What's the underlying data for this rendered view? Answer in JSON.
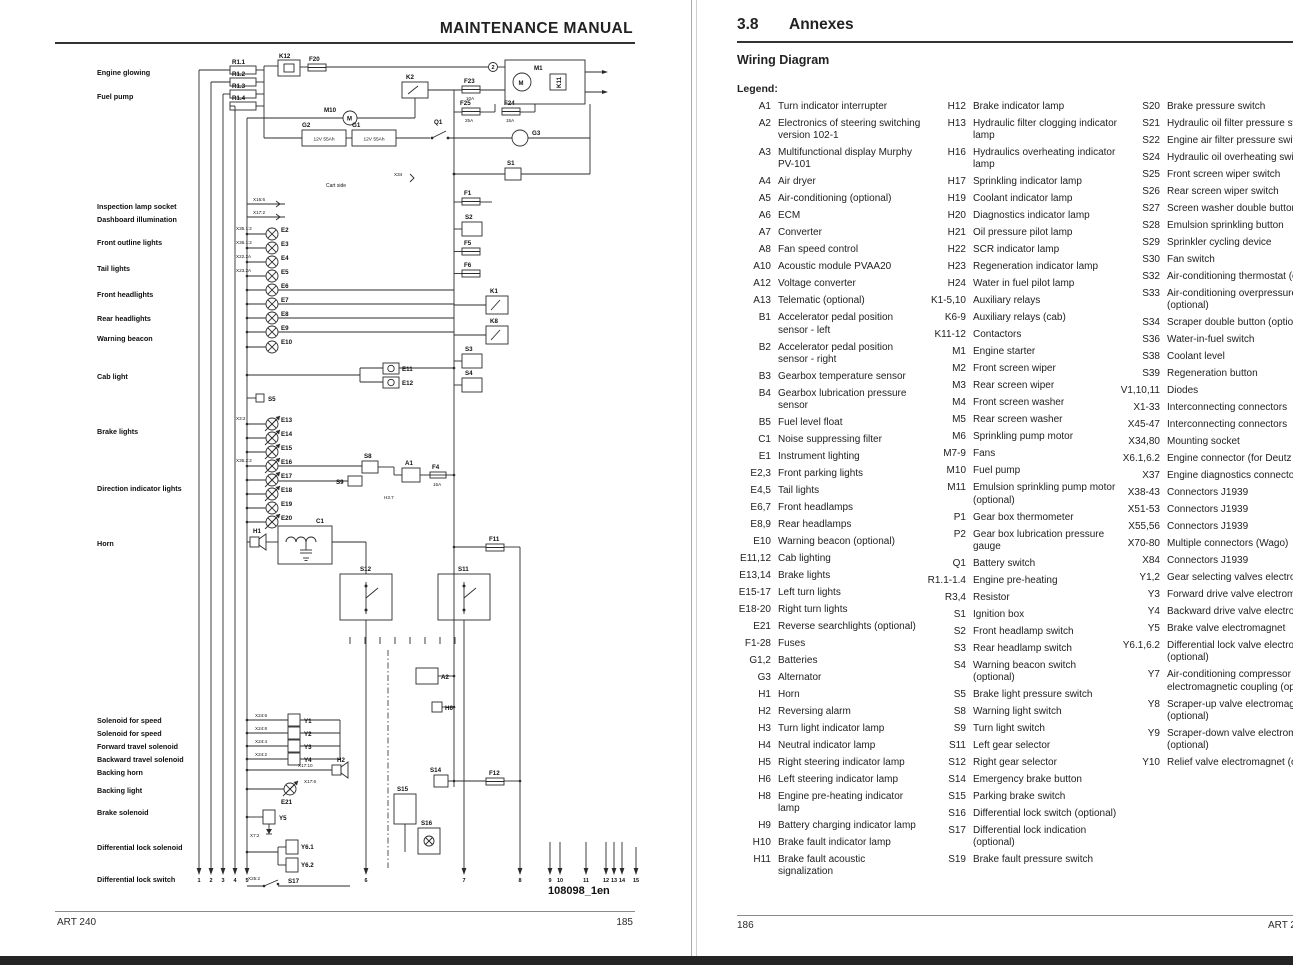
{
  "left_page": {
    "header_title": "MAINTENANCE MANUAL",
    "footer_left": "ART 240",
    "footer_right": "185",
    "diagram": {
      "ref": "108098_1en",
      "side_labels": [
        "Engine glowing",
        "Fuel pump",
        "Inspection lamp socket",
        "Dashboard illumination",
        "Front outline lights",
        "Tail lights",
        "Front headlights",
        "Rear headlights",
        "Warning beacon",
        "Cab light",
        "Brake lights",
        "Direction indicator lights",
        "Horn",
        "Solenoid for speed",
        "Solenoid for speed",
        "Forward travel solenoid",
        "Backward travel solenoid",
        "Backing horn",
        "Backing light",
        "Brake solenoid",
        "Differential lock solenoid",
        "Differential lock switch"
      ],
      "texts": [
        "R1.1",
        "R1.2",
        "R1.3",
        "R1.4",
        "K12",
        "F20",
        "M10",
        "K2",
        "F23",
        "10A",
        "F25",
        "25A",
        "F24",
        "15A",
        "M1",
        "K11",
        "2",
        "G2",
        "12V 55Ah",
        "G1",
        "12V 55Ah",
        "Q1",
        "G3",
        "S1",
        "X34",
        "F1",
        "S2",
        "F5",
        "F6",
        "K1",
        "K8",
        "S3",
        "S4",
        "X16:6",
        "X17:2",
        "E2",
        "E3",
        "E4",
        "E5",
        "E6",
        "E7",
        "E8",
        "E9",
        "E10",
        "X35.1:2",
        "X36.1:2",
        "X22.2A",
        "X23.2A",
        "E11",
        "E12",
        "S5",
        "E13",
        "E14",
        "E15",
        "E16",
        "E17",
        "E18",
        "E19",
        "E20",
        "X3:2",
        "X35.2:2",
        "S8",
        "S9",
        "A1",
        "F4",
        "15A",
        "H3.7",
        "H1",
        "C1",
        "F11",
        "S12",
        "S11",
        "A2",
        "H6",
        "Y1",
        "Y2",
        "Y3",
        "Y4",
        "X24:6",
        "X24:8",
        "X24:4",
        "X24:2",
        "H2",
        "X17:10",
        "E21",
        "X17:6",
        "Y5",
        "Y6.1",
        "Y6.2",
        "S17",
        "X25:2",
        "X7:2",
        "S14",
        "F12",
        "S15",
        "S16",
        "Cart side",
        "M",
        "M"
      ],
      "terminals": [
        "1",
        "2",
        "3",
        "4",
        "5",
        "6",
        "7",
        "8",
        "9",
        "10",
        "11",
        "12",
        "13",
        "14",
        "15"
      ]
    }
  },
  "right_page": {
    "section_number": "3.8",
    "section_title": "Annexes",
    "subtitle": "Wiring Diagram",
    "legend_label": "Legend:",
    "footer_left": "186",
    "footer_right": "ART 240",
    "legend_col1": [
      {
        "k": "A1",
        "d": "Turn indicator interrupter"
      },
      {
        "k": "A2",
        "d": "Electronics of steering switching version 102-1"
      },
      {
        "k": "A3",
        "d": "Multifunctional display Murphy PV-101"
      },
      {
        "k": "A4",
        "d": "Air dryer"
      },
      {
        "k": "A5",
        "d": "Air-conditioning (optional)"
      },
      {
        "k": "A6",
        "d": "ECM"
      },
      {
        "k": "A7",
        "d": "Converter"
      },
      {
        "k": "A8",
        "d": "Fan speed control"
      },
      {
        "k": "A10",
        "d": "Acoustic module PVAA20"
      },
      {
        "k": "A12",
        "d": "Voltage converter"
      },
      {
        "k": "A13",
        "d": "Telematic (optional)"
      },
      {
        "k": "B1",
        "d": "Accelerator pedal position sensor - left"
      },
      {
        "k": "B2",
        "d": "Accelerator pedal position sensor - right"
      },
      {
        "k": "B3",
        "d": "Gearbox temperature sensor"
      },
      {
        "k": "B4",
        "d": "Gearbox lubrication pressure sensor"
      },
      {
        "k": "B5",
        "d": "Fuel level float"
      },
      {
        "k": "C1",
        "d": "Noise suppressing filter"
      },
      {
        "k": "E1",
        "d": "Instrument lighting"
      },
      {
        "k": "E2,3",
        "d": "Front parking lights"
      },
      {
        "k": "E4,5",
        "d": "Tail lights"
      },
      {
        "k": "E6,7",
        "d": "Front headlamps"
      },
      {
        "k": "E8,9",
        "d": "Rear headlamps"
      },
      {
        "k": "E10",
        "d": "Warning beacon (optional)"
      },
      {
        "k": "E11,12",
        "d": "Cab lighting"
      },
      {
        "k": "E13,14",
        "d": "Brake lights"
      },
      {
        "k": "E15-17",
        "d": "Left turn lights"
      },
      {
        "k": "E18-20",
        "d": "Right turn lights"
      },
      {
        "k": "E21",
        "d": "Reverse searchlights (optional)"
      },
      {
        "k": "F1-28",
        "d": "Fuses"
      },
      {
        "k": "G1,2",
        "d": "Batteries"
      },
      {
        "k": "G3",
        "d": "Alternator"
      },
      {
        "k": "H1",
        "d": "Horn"
      },
      {
        "k": "H2",
        "d": "Reversing alarm"
      },
      {
        "k": "H3",
        "d": "Turn light indicator lamp"
      },
      {
        "k": "H4",
        "d": "Neutral indicator lamp"
      },
      {
        "k": "H5",
        "d": "Right steering indicator lamp"
      },
      {
        "k": "H6",
        "d": "Left steering indicator lamp"
      },
      {
        "k": "H8",
        "d": "Engine pre-heating indicator lamp"
      },
      {
        "k": "H9",
        "d": "Battery charging indicator lamp"
      },
      {
        "k": "H10",
        "d": "Brake fault indicator lamp"
      },
      {
        "k": "H11",
        "d": "Brake fault acoustic signalization"
      }
    ],
    "legend_col2": [
      {
        "k": "H12",
        "d": "Brake indicator lamp"
      },
      {
        "k": "H13",
        "d": "Hydraulic filter clogging indicator lamp"
      },
      {
        "k": "H16",
        "d": "Hydraulics overheating indicator lamp"
      },
      {
        "k": "H17",
        "d": "Sprinkling indicator lamp"
      },
      {
        "k": "H19",
        "d": "Coolant indicator lamp"
      },
      {
        "k": "H20",
        "d": "Diagnostics indicator lamp"
      },
      {
        "k": "H21",
        "d": "Oil pressure pilot lamp"
      },
      {
        "k": "H22",
        "d": "SCR indicator lamp"
      },
      {
        "k": "H23",
        "d": "Regeneration indicator lamp"
      },
      {
        "k": "H24",
        "d": "Water in fuel pilot lamp"
      },
      {
        "k": "K1-5,10",
        "d": "Auxiliary relays"
      },
      {
        "k": "K6-9",
        "d": "Auxiliary relays (cab)"
      },
      {
        "k": "K11-12",
        "d": "Contactors"
      },
      {
        "k": "M1",
        "d": "Engine starter"
      },
      {
        "k": "M2",
        "d": "Front screen wiper"
      },
      {
        "k": "M3",
        "d": "Rear screen wiper"
      },
      {
        "k": "M4",
        "d": "Front screen washer"
      },
      {
        "k": "M5",
        "d": "Rear screen washer"
      },
      {
        "k": "M6",
        "d": "Sprinkling pump motor"
      },
      {
        "k": "M7-9",
        "d": "Fans"
      },
      {
        "k": "M10",
        "d": "Fuel pump"
      },
      {
        "k": "M11",
        "d": "Emulsion sprinkling pump motor (optional)"
      },
      {
        "k": "P1",
        "d": "Gear box thermometer"
      },
      {
        "k": "P2",
        "d": "Gear box lubrication pressure gauge"
      },
      {
        "k": "Q1",
        "d": "Battery switch"
      },
      {
        "k": "R1.1-1.4",
        "d": "Engine pre-heating"
      },
      {
        "k": "R3,4",
        "d": "Resistor"
      },
      {
        "k": "S1",
        "d": "Ignition box"
      },
      {
        "k": "S2",
        "d": "Front headlamp switch"
      },
      {
        "k": "S3",
        "d": "Rear headlamp switch"
      },
      {
        "k": "S4",
        "d": "Warning beacon switch (optional)"
      },
      {
        "k": "S5",
        "d": "Brake light pressure switch"
      },
      {
        "k": "S8",
        "d": "Warning light switch"
      },
      {
        "k": "S9",
        "d": "Turn light switch"
      },
      {
        "k": "S11",
        "d": "Left gear selector"
      },
      {
        "k": "S12",
        "d": "Right gear selector"
      },
      {
        "k": "S14",
        "d": "Emergency brake button"
      },
      {
        "k": "S15",
        "d": "Parking brake switch"
      },
      {
        "k": "S16",
        "d": "Differential lock switch (optional)"
      },
      {
        "k": "S17",
        "d": "Differential lock indication (optional)"
      },
      {
        "k": "S19",
        "d": "Brake fault pressure switch"
      }
    ],
    "legend_col3": [
      {
        "k": "S20",
        "d": "Brake pressure switch"
      },
      {
        "k": "S21",
        "d": "Hydraulic oil filter pressure switch"
      },
      {
        "k": "S22",
        "d": "Engine air filter pressure switch"
      },
      {
        "k": "S24",
        "d": "Hydraulic oil overheating switch"
      },
      {
        "k": "S25",
        "d": "Front screen wiper switch"
      },
      {
        "k": "S26",
        "d": "Rear screen wiper switch"
      },
      {
        "k": "S27",
        "d": "Screen washer double button"
      },
      {
        "k": "S28",
        "d": "Emulsion sprinkling button"
      },
      {
        "k": "S29",
        "d": "Sprinkler cycling device"
      },
      {
        "k": "S30",
        "d": "Fan switch"
      },
      {
        "k": "S32",
        "d": "Air-conditioning thermostat (optional)"
      },
      {
        "k": "S33",
        "d": "Air-conditioning overpressure fuse (optional)"
      },
      {
        "k": "S34",
        "d": "Scraper double button (optional)"
      },
      {
        "k": "S36",
        "d": "Water-in-fuel switch"
      },
      {
        "k": "S38",
        "d": "Coolant level"
      },
      {
        "k": "S39",
        "d": "Regeneration button"
      },
      {
        "k": "V1,10,11",
        "d": "Diodes"
      },
      {
        "k": "X1-33",
        "d": "Interconnecting connectors"
      },
      {
        "k": "X45-47",
        "d": "Interconnecting connectors"
      },
      {
        "k": "X34,80",
        "d": "Mounting socket"
      },
      {
        "k": "X6.1,6.2",
        "d": "Engine connector (for Deutz X23)"
      },
      {
        "k": "X37",
        "d": "Engine diagnostics connector"
      },
      {
        "k": "X38-43",
        "d": "Connectors J1939"
      },
      {
        "k": "X51-53",
        "d": "Connectors J1939"
      },
      {
        "k": "X55,56",
        "d": "Connectors J1939"
      },
      {
        "k": "X70-80",
        "d": "Multiple connectors (Wago)"
      },
      {
        "k": "X84",
        "d": "Connectors J1939"
      },
      {
        "k": "Y1,2",
        "d": "Gear selecting valves electromagnets"
      },
      {
        "k": "Y3",
        "d": "Forward drive valve electromagnet"
      },
      {
        "k": "Y4",
        "d": "Backward drive valve electromagnet"
      },
      {
        "k": "Y5",
        "d": "Brake valve electromagnet"
      },
      {
        "k": "Y6.1,6.2",
        "d": "Differential lock valve electromagnets (optional)"
      },
      {
        "k": "Y7",
        "d": "Air-conditioning compressor electromagnetic coupling (optional)"
      },
      {
        "k": "Y8",
        "d": "Scraper-up valve electromagnet (optional)"
      },
      {
        "k": "Y9",
        "d": "Scraper-down valve electromagnet (optional)"
      },
      {
        "k": "Y10",
        "d": "Relief valve electromagnet (optional)"
      }
    ]
  }
}
